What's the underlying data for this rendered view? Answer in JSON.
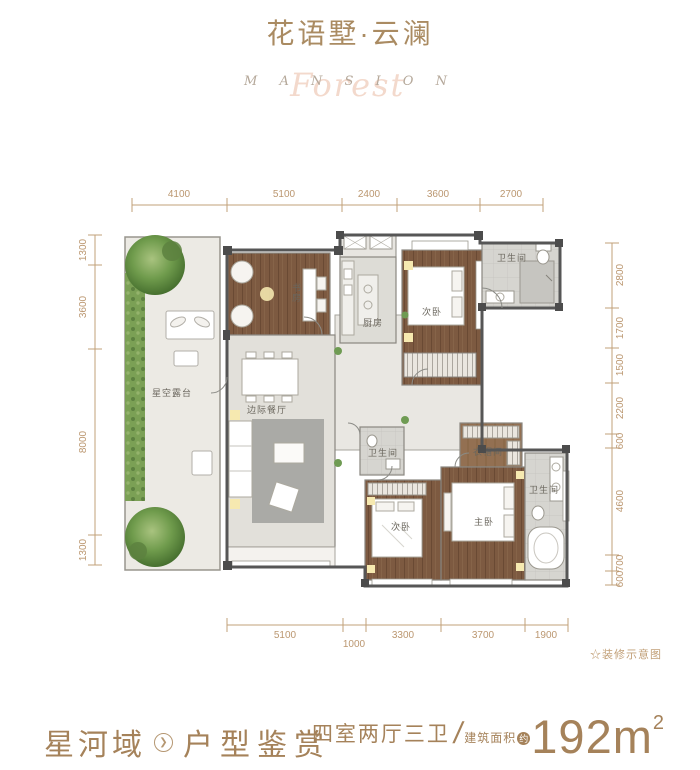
{
  "colors": {
    "accent_brown": "#a5825a",
    "title_brown": "#aa8b62",
    "dimension_tan": "#c2a078",
    "watermark_pink": "#f3d9cc",
    "wall_gray": "#5a5a5a",
    "wood_floor": "#7d5a41",
    "plant_green": "#679a4c"
  },
  "header": {
    "title": "花语墅·云澜",
    "watermark_letters": "M A N S I O N",
    "watermark_script": "Forest"
  },
  "plan": {
    "note": "☆装修示意图",
    "dims_top": [
      "4100",
      "5100",
      "2400",
      "3600",
      "2700"
    ],
    "dims_left": [
      "1300",
      "3600",
      "8000",
      "1300"
    ],
    "dims_right": [
      "2800",
      "1700",
      "1500",
      "2200",
      "600",
      "4600",
      "700",
      "600"
    ],
    "dims_bottom": [
      "5100",
      "1000",
      "3300",
      "3700",
      "1900"
    ],
    "rooms": {
      "terrace": "星空露台",
      "study": "书房",
      "utility_balcony": "阳台",
      "kitchen": "厨房",
      "bedroom_top": "次卧",
      "bath_top": "卫生间",
      "hall": "边际餐厅",
      "bath_mid": "卫生间",
      "cloakroom": "衣帽间",
      "bedroom_second": "次卧",
      "master_bedroom": "主卧",
      "bath_master": "卫生间"
    }
  },
  "footer": {
    "brand": "星河域",
    "section": "户型鉴赏",
    "layout_type": "四室两厅三卫",
    "area_prefix": "建筑面积",
    "area_approx": "约",
    "area_number": "192m",
    "area_sup": "2"
  }
}
